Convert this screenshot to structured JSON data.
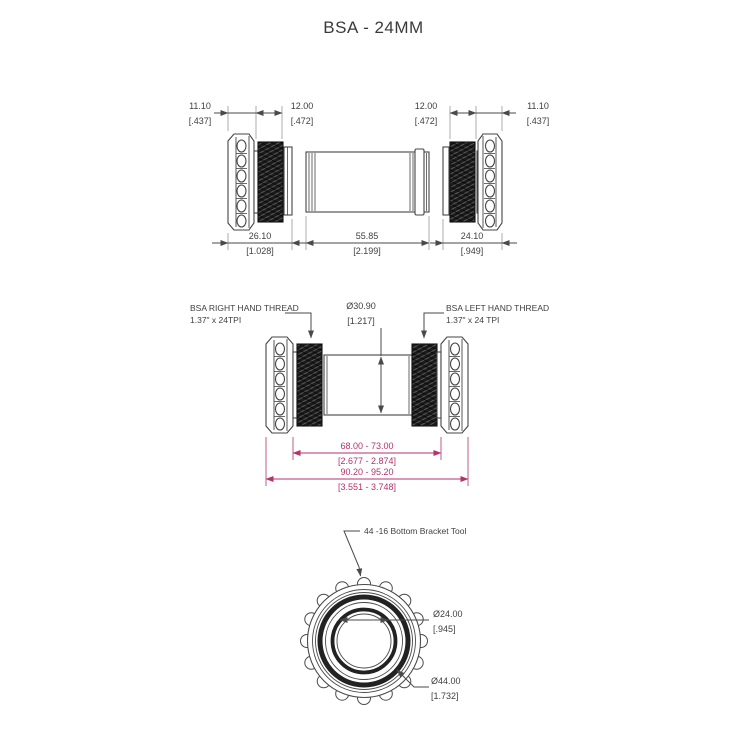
{
  "title": "BSA - 24MM",
  "colors": {
    "line": "#4a4a4a",
    "text": "#3f3f3f",
    "accent": "#b4326e"
  },
  "top_view": {
    "dims_top": [
      {
        "mm": "11.10",
        "in": "[.437]"
      },
      {
        "mm": "12.00",
        "in": "[.472]"
      },
      {
        "mm": "12.00",
        "in": "[.472]"
      },
      {
        "mm": "11.10",
        "in": "[.437]"
      }
    ],
    "dims_bottom": [
      {
        "mm": "26.10",
        "in": "[1.028]"
      },
      {
        "mm": "55.85",
        "in": "[2.199]"
      },
      {
        "mm": "24.10",
        "in": "[.949]"
      }
    ]
  },
  "middle_view": {
    "right_thread_label": {
      "line1": "BSA RIGHT HAND THREAD",
      "line2": "1.37\" x 24TPI"
    },
    "left_thread_label": {
      "line1": "BSA LEFT HAND THREAD",
      "line2": "1.37\" x 24 TPI"
    },
    "diameter_label": {
      "mm": "Ø30.90",
      "in": "[1.217]"
    },
    "dims": [
      {
        "mm": "68.00 - 73.00",
        "in": "[2.677 - 2.874]"
      },
      {
        "mm": "90.20 - 95.20",
        "in": "[3.551 - 3.748]"
      }
    ]
  },
  "bottom_view": {
    "tool_label": "44 -16 Bottom Bracket Tool",
    "bore_dia": {
      "mm": "Ø24.00",
      "in": "[.945]"
    },
    "outer_dia": {
      "mm": "Ø44.00",
      "in": "[1.732]"
    }
  }
}
